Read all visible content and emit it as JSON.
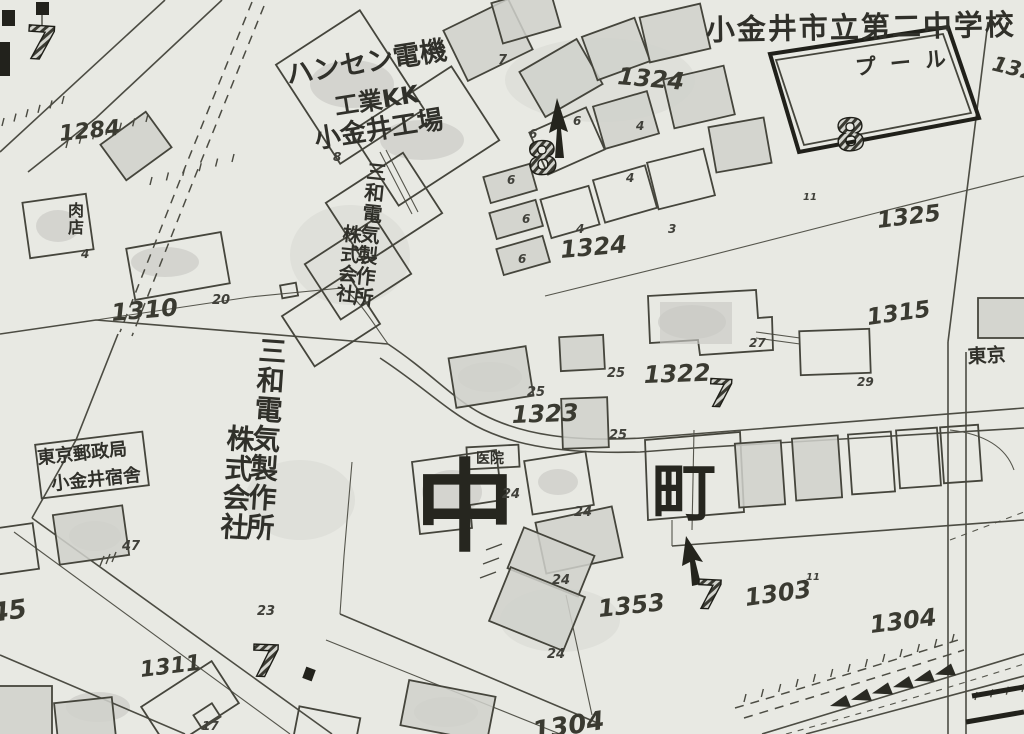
{
  "map": {
    "description": "Hand-drawn Japanese cadastral map, Naka-machi district, Koganei",
    "colors": {
      "paper": "#e8e9e3",
      "ink": "#3b3b33",
      "ink_dark": "#21211b",
      "pencil_fill": "#cfd0ca"
    },
    "labels": [
      {
        "id": "school-name",
        "text": "小金井市立第二中学校",
        "x": 706,
        "y": 40,
        "size": 29,
        "rot": -1,
        "ls": 2
      },
      {
        "id": "pool-label",
        "text": "プール",
        "x": 856,
        "y": 75,
        "size": 21,
        "rot": -6,
        "ls": 14
      },
      {
        "id": "parcel-132-cut",
        "text": "132",
        "x": 991,
        "y": 70,
        "size": 21,
        "rot": 14,
        "style": "num"
      },
      {
        "id": "hansen-line1",
        "text": "ハンセン電機",
        "x": 288,
        "y": 84,
        "size": 27,
        "rot": -9
      },
      {
        "id": "hansen-line2",
        "text": "工業KK",
        "x": 336,
        "y": 115,
        "size": 24,
        "rot": -9
      },
      {
        "id": "hansen-line3",
        "text": "小金井工場",
        "x": 316,
        "y": 148,
        "size": 26,
        "rot": -9
      },
      {
        "id": "sanwa-small-col1",
        "text": "三和電気製作所",
        "x": 366,
        "y": 178,
        "size": 20,
        "rot": 6,
        "v": true
      },
      {
        "id": "sanwa-small-col2",
        "text": "株式会社",
        "x": 342,
        "y": 240,
        "size": 19,
        "rot": 6,
        "v": true
      },
      {
        "id": "sanwa-large-col1",
        "text": "三和電気製作所",
        "x": 258,
        "y": 360,
        "size": 28,
        "rot": 4,
        "v": true
      },
      {
        "id": "sanwa-large-col2",
        "text": "株式会社",
        "x": 226,
        "y": 448,
        "size": 28,
        "rot": 4,
        "v": true
      },
      {
        "id": "postal-line1",
        "text": "東京郵政局",
        "x": 38,
        "y": 464,
        "size": 18,
        "rot": -6
      },
      {
        "id": "postal-line2",
        "text": "小金井宿舎",
        "x": 52,
        "y": 490,
        "size": 18,
        "rot": -6
      },
      {
        "id": "meat-shop-label",
        "text": "肉店",
        "x": 68,
        "y": 216,
        "size": 16,
        "v": true
      },
      {
        "id": "clinic-label",
        "text": "医院",
        "x": 476,
        "y": 463,
        "size": 14
      },
      {
        "id": "naka-character",
        "text": "中",
        "x": 465,
        "y": 542,
        "size": 100,
        "style": "huge",
        "anchor": "middle"
      },
      {
        "id": "machi-character",
        "text": "町",
        "x": 684,
        "y": 515,
        "size": 64,
        "style": "huge",
        "anchor": "middle"
      },
      {
        "id": "tokyo-cut",
        "text": "東京",
        "x": 968,
        "y": 363,
        "size": 19,
        "rot": -3
      },
      {
        "id": "parcel-1284",
        "text": "1284",
        "x": 60,
        "y": 141,
        "size": 22,
        "rot": -6,
        "style": "num"
      },
      {
        "id": "parcel-1310",
        "text": "1310",
        "x": 112,
        "y": 321,
        "size": 24,
        "rot": -5,
        "style": "num"
      },
      {
        "id": "parcel-1324-north",
        "text": "1324",
        "x": 617,
        "y": 84,
        "size": 24,
        "rot": 5,
        "style": "num"
      },
      {
        "id": "parcel-1324-south",
        "text": "1324",
        "x": 561,
        "y": 258,
        "size": 24,
        "rot": -5,
        "style": "num"
      },
      {
        "id": "parcel-1325",
        "text": "1325",
        "x": 878,
        "y": 228,
        "size": 23,
        "rot": -7,
        "style": "num"
      },
      {
        "id": "parcel-1315",
        "text": "1315",
        "x": 868,
        "y": 325,
        "size": 23,
        "rot": -8,
        "style": "num"
      },
      {
        "id": "parcel-1322",
        "text": "1322",
        "x": 644,
        "y": 383,
        "size": 24,
        "rot": -2,
        "style": "num"
      },
      {
        "id": "parcel-1323",
        "text": "1323",
        "x": 512,
        "y": 423,
        "size": 24,
        "rot": -2,
        "style": "num"
      },
      {
        "id": "parcel-1353",
        "text": "1353",
        "x": 599,
        "y": 617,
        "size": 24,
        "rot": -6,
        "style": "num"
      },
      {
        "id": "parcel-1303",
        "text": "1303",
        "x": 746,
        "y": 606,
        "size": 24,
        "rot": -8,
        "style": "num"
      },
      {
        "id": "parcel-1304",
        "text": "1304",
        "x": 871,
        "y": 633,
        "size": 24,
        "rot": -7,
        "style": "num"
      },
      {
        "id": "parcel-1311",
        "text": "1311",
        "x": 141,
        "y": 677,
        "size": 22,
        "rot": -7,
        "style": "num"
      },
      {
        "id": "parcel-45-cut",
        "text": "45",
        "x": -8,
        "y": 622,
        "size": 26,
        "rot": -8,
        "style": "num"
      },
      {
        "id": "parcel-130x-cut",
        "text": "1304",
        "x": 534,
        "y": 740,
        "size": 26,
        "rot": -9,
        "style": "num"
      },
      {
        "id": "lot-20",
        "text": "20",
        "x": 212,
        "y": 304,
        "size": 13,
        "style": "num-sm"
      },
      {
        "id": "lot-25-a",
        "text": "25",
        "x": 527,
        "y": 396,
        "size": 13,
        "style": "num-sm"
      },
      {
        "id": "lot-25-b",
        "text": "25",
        "x": 607,
        "y": 377,
        "size": 13,
        "style": "num-sm"
      },
      {
        "id": "lot-25-c",
        "text": "25",
        "x": 609,
        "y": 439,
        "size": 13,
        "style": "num-sm"
      },
      {
        "id": "lot-24-a",
        "text": "24",
        "x": 502,
        "y": 498,
        "size": 13,
        "style": "num-sm"
      },
      {
        "id": "lot-24-b",
        "text": "24",
        "x": 574,
        "y": 516,
        "size": 13,
        "style": "num-sm"
      },
      {
        "id": "lot-24-c",
        "text": "24",
        "x": 552,
        "y": 584,
        "size": 13,
        "style": "num-sm"
      },
      {
        "id": "lot-24-d",
        "text": "24",
        "x": 547,
        "y": 658,
        "size": 13,
        "style": "num-sm"
      },
      {
        "id": "lot-23",
        "text": "23",
        "x": 257,
        "y": 615,
        "size": 13,
        "style": "num-sm"
      },
      {
        "id": "lot-47",
        "text": "47",
        "x": 122,
        "y": 550,
        "size": 13,
        "style": "num-sm"
      },
      {
        "id": "lot-27",
        "text": "27",
        "x": 749,
        "y": 347,
        "size": 12,
        "style": "num-sm"
      },
      {
        "id": "lot-29",
        "text": "29",
        "x": 857,
        "y": 386,
        "size": 12,
        "style": "num-sm"
      },
      {
        "id": "lot-17",
        "text": "17",
        "x": 202,
        "y": 730,
        "size": 12,
        "style": "num-sm"
      },
      {
        "id": "lot-4-shop",
        "text": "4",
        "x": 81,
        "y": 258,
        "size": 12,
        "style": "num-sm"
      },
      {
        "id": "lot-7-small",
        "text": "7",
        "x": 498,
        "y": 64,
        "size": 13,
        "style": "num-sm"
      },
      {
        "id": "lot-8-small",
        "text": "8",
        "x": 333,
        "y": 161,
        "size": 12,
        "style": "num-sm"
      },
      {
        "id": "lot-6-a",
        "text": "6",
        "x": 529,
        "y": 138,
        "size": 12,
        "style": "num-sm"
      },
      {
        "id": "lot-6-b",
        "text": "6",
        "x": 573,
        "y": 125,
        "size": 12,
        "style": "num-sm"
      },
      {
        "id": "lot-6-c",
        "text": "6",
        "x": 507,
        "y": 184,
        "size": 12,
        "style": "num-sm"
      },
      {
        "id": "lot-6-d",
        "text": "6",
        "x": 522,
        "y": 223,
        "size": 12,
        "style": "num-sm"
      },
      {
        "id": "lot-6-e",
        "text": "6",
        "x": 518,
        "y": 263,
        "size": 12,
        "style": "num-sm"
      },
      {
        "id": "lot-4-a",
        "text": "4",
        "x": 636,
        "y": 130,
        "size": 12,
        "style": "num-sm"
      },
      {
        "id": "lot-4-b",
        "text": "4",
        "x": 626,
        "y": 182,
        "size": 12,
        "style": "num-sm"
      },
      {
        "id": "lot-4-c",
        "text": "4",
        "x": 576,
        "y": 233,
        "size": 12,
        "style": "num-sm"
      },
      {
        "id": "lot-3-a",
        "text": "3",
        "x": 668,
        "y": 233,
        "size": 12,
        "style": "num-sm"
      },
      {
        "id": "bench-11-a",
        "text": "11",
        "x": 803,
        "y": 200,
        "size": 10,
        "style": "num-sm"
      },
      {
        "id": "bench-11-b",
        "text": "11",
        "x": 806,
        "y": 580,
        "size": 10,
        "style": "num-sm"
      },
      {
        "id": "block-7-topleft",
        "text": "7",
        "x": 24,
        "y": 58,
        "size": 46,
        "rot": 4,
        "style": "bold-num"
      },
      {
        "id": "block-8-center",
        "text": "8",
        "x": 528,
        "y": 175,
        "size": 45,
        "rot": -4,
        "style": "bold-num"
      },
      {
        "id": "block-8-right",
        "text": "8",
        "x": 836,
        "y": 151,
        "size": 44,
        "rot": -3,
        "style": "bold-num"
      },
      {
        "id": "block-7-1322",
        "text": "7",
        "x": 707,
        "y": 406,
        "size": 38,
        "rot": 3,
        "style": "bold-num"
      },
      {
        "id": "block-7-1311",
        "text": "7",
        "x": 250,
        "y": 676,
        "size": 44,
        "rot": 2,
        "style": "bold-num"
      },
      {
        "id": "block-7-1303",
        "text": "7",
        "x": 695,
        "y": 608,
        "size": 40,
        "rot": 3,
        "style": "bold-num"
      }
    ]
  }
}
